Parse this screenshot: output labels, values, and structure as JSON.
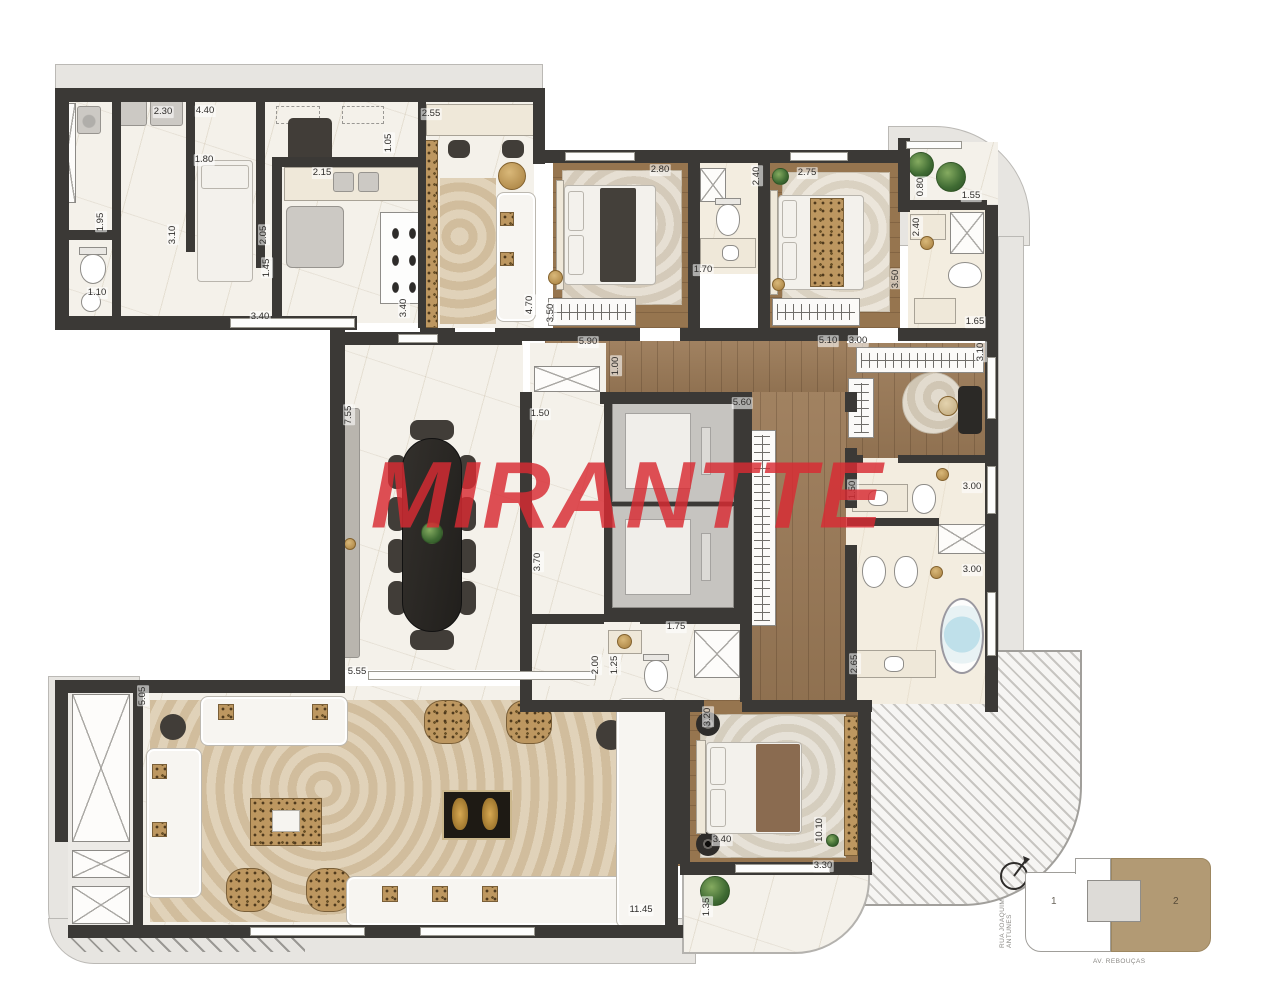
{
  "watermark": "MIRANTTE",
  "colors": {
    "wall": "#3b3936",
    "watermark_red": "#d92b33",
    "wood_floor": "#9b7a57",
    "marble_floor": "#f4f1ea",
    "carpet": "#d9c7a8",
    "keyplan_highlight": "#b29a74",
    "outline_band": "#e7e5e1"
  },
  "floorplan": {
    "dimensions": [
      {
        "text": "2.30",
        "x": 163,
        "y": 112,
        "rot": "h"
      },
      {
        "text": "4.40",
        "x": 205,
        "y": 111,
        "rot": "h"
      },
      {
        "text": "1.80",
        "x": 204,
        "y": 160,
        "rot": "h"
      },
      {
        "text": "2.15",
        "x": 322,
        "y": 173,
        "rot": "h"
      },
      {
        "text": "1.05",
        "x": 389,
        "y": 143,
        "rot": "v"
      },
      {
        "text": "2.55",
        "x": 431,
        "y": 114,
        "rot": "h"
      },
      {
        "text": "1.95",
        "x": 101,
        "y": 222,
        "rot": "v"
      },
      {
        "text": "3.10",
        "x": 173,
        "y": 235,
        "rot": "v"
      },
      {
        "text": "2.05",
        "x": 264,
        "y": 235,
        "rot": "v"
      },
      {
        "text": "1.45",
        "x": 267,
        "y": 268,
        "rot": "v"
      },
      {
        "text": "1.10",
        "x": 97,
        "y": 293,
        "rot": "h"
      },
      {
        "text": "3.40",
        "x": 260,
        "y": 317,
        "rot": "h"
      },
      {
        "text": "3.40",
        "x": 404,
        "y": 308,
        "rot": "v"
      },
      {
        "text": "2.80",
        "x": 660,
        "y": 170,
        "rot": "h"
      },
      {
        "text": "2.40",
        "x": 757,
        "y": 176,
        "rot": "v"
      },
      {
        "text": "2.75",
        "x": 807,
        "y": 173,
        "rot": "h"
      },
      {
        "text": "0.80",
        "x": 921,
        "y": 187,
        "rot": "v"
      },
      {
        "text": "1.55",
        "x": 971,
        "y": 196,
        "rot": "h"
      },
      {
        "text": "2.40",
        "x": 917,
        "y": 227,
        "rot": "v"
      },
      {
        "text": "1.70",
        "x": 703,
        "y": 270,
        "rot": "h"
      },
      {
        "text": "3.50",
        "x": 551,
        "y": 313,
        "rot": "v"
      },
      {
        "text": "3.50",
        "x": 896,
        "y": 279,
        "rot": "v"
      },
      {
        "text": "4.70",
        "x": 530,
        "y": 305,
        "rot": "v"
      },
      {
        "text": "1.65",
        "x": 975,
        "y": 322,
        "rot": "h"
      },
      {
        "text": "5.90",
        "x": 588,
        "y": 342,
        "rot": "h"
      },
      {
        "text": "1.00",
        "x": 616,
        "y": 366,
        "rot": "v"
      },
      {
        "text": "5.10",
        "x": 828,
        "y": 341,
        "rot": "h"
      },
      {
        "text": "3.00",
        "x": 858,
        "y": 341,
        "rot": "h"
      },
      {
        "text": "3.10",
        "x": 981,
        "y": 352,
        "rot": "v"
      },
      {
        "text": "7.55",
        "x": 349,
        "y": 415,
        "rot": "v"
      },
      {
        "text": "1.50",
        "x": 540,
        "y": 414,
        "rot": "h"
      },
      {
        "text": "3.70",
        "x": 538,
        "y": 562,
        "rot": "v"
      },
      {
        "text": "5.60",
        "x": 742,
        "y": 403,
        "rot": "h"
      },
      {
        "text": "5.55",
        "x": 357,
        "y": 672,
        "rot": "h"
      },
      {
        "text": "1.75",
        "x": 676,
        "y": 627,
        "rot": "h"
      },
      {
        "text": "2.00",
        "x": 596,
        "y": 665,
        "rot": "v"
      },
      {
        "text": "1.25",
        "x": 615,
        "y": 665,
        "rot": "v"
      },
      {
        "text": "1.50",
        "x": 853,
        "y": 490,
        "rot": "v"
      },
      {
        "text": "3.00",
        "x": 972,
        "y": 487,
        "rot": "h"
      },
      {
        "text": "3.00",
        "x": 972,
        "y": 570,
        "rot": "h"
      },
      {
        "text": "2.65",
        "x": 855,
        "y": 664,
        "rot": "v"
      },
      {
        "text": "3.20",
        "x": 708,
        "y": 717,
        "rot": "v"
      },
      {
        "text": "3.40",
        "x": 722,
        "y": 840,
        "rot": "h"
      },
      {
        "text": "10.10",
        "x": 820,
        "y": 830,
        "rot": "v"
      },
      {
        "text": "3.30",
        "x": 823,
        "y": 866,
        "rot": "h"
      },
      {
        "text": "1.35",
        "x": 707,
        "y": 907,
        "rot": "v"
      },
      {
        "text": "11.45",
        "x": 641,
        "y": 910,
        "rot": "h"
      },
      {
        "text": "5.05",
        "x": 143,
        "y": 696,
        "rot": "v"
      }
    ]
  },
  "keyplan": {
    "unit1_label": "1",
    "unit2_label": "2",
    "street_left": "RUA JOAQUIM ANTUNES",
    "street_bottom": "AV. REBOUÇAS"
  }
}
